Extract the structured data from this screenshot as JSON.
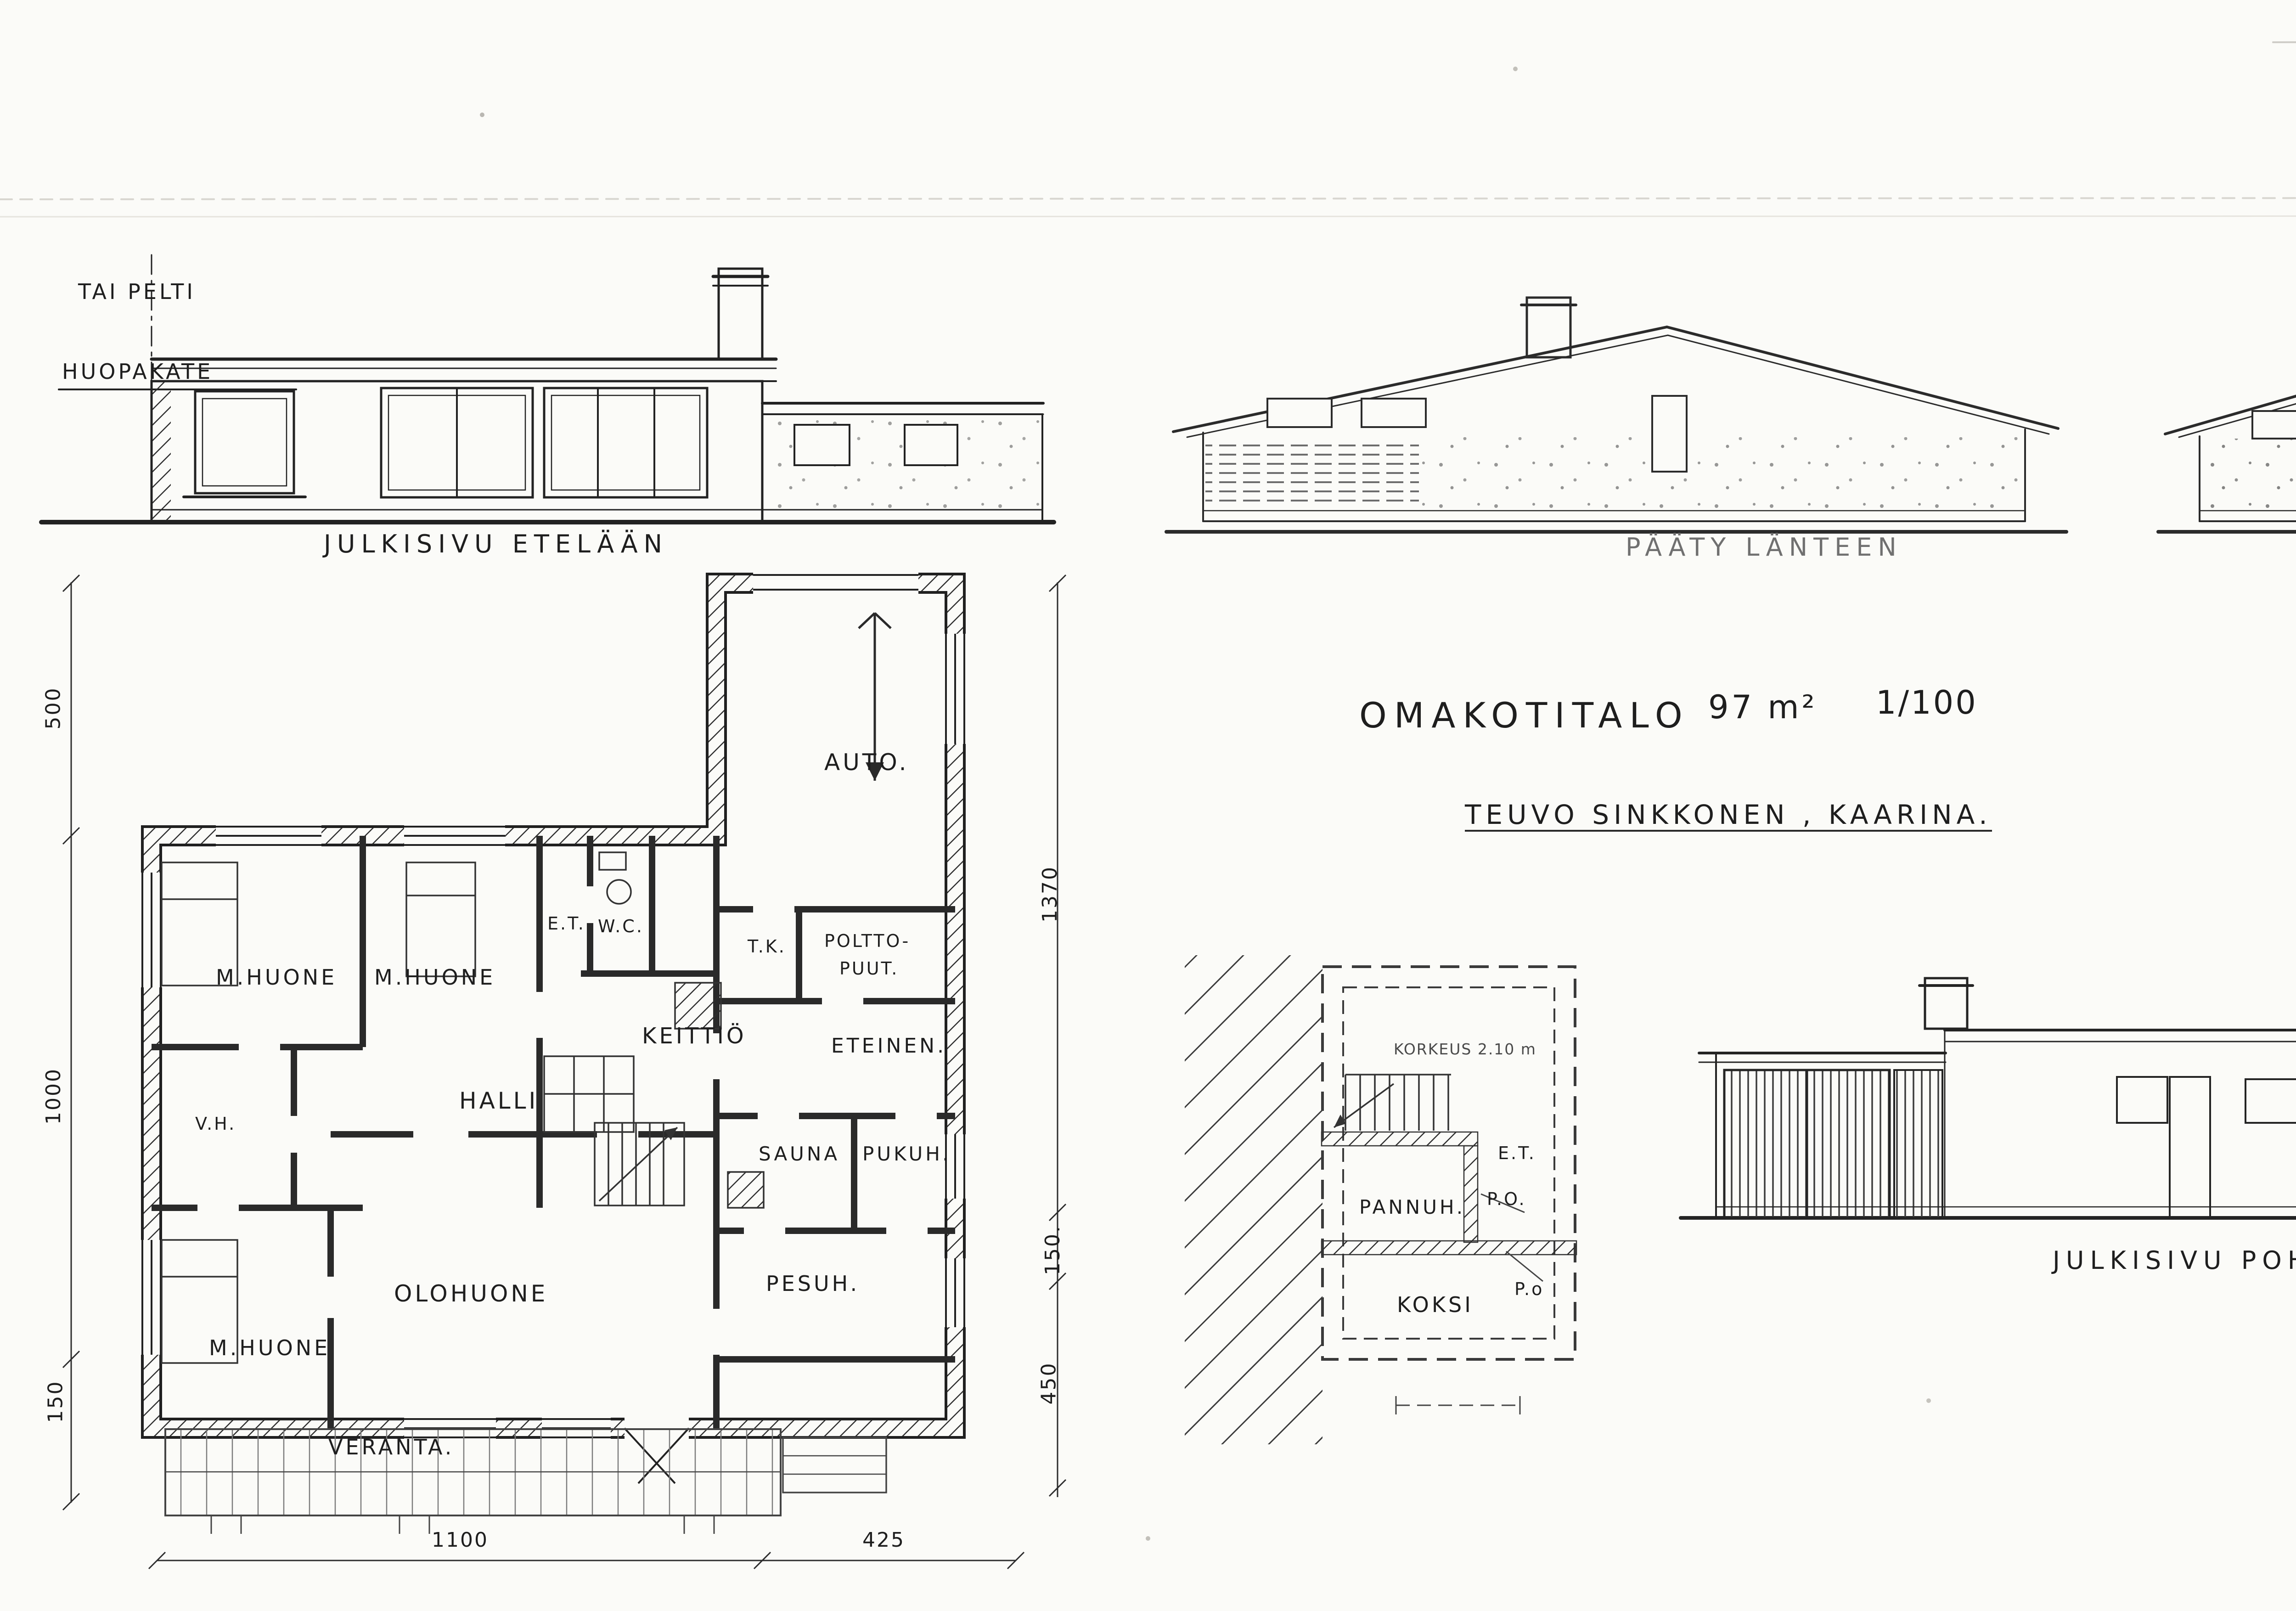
{
  "title_block": {
    "project": "OMAKOTITALO",
    "area": "97 m²",
    "scale": "1/100",
    "client": "TEUVO SINKKONEN , KAARINA."
  },
  "elevation_south": {
    "title": "JULKISIVU ETELÄÄN",
    "note_roof_alt": "TAI PELTI",
    "note_roof": "HUOPAKATE"
  },
  "elevation_west": {
    "title": "PÄÄTY LÄNTEEN"
  },
  "elevation_east": {
    "title": "PÄÄTY ITÄÄN.",
    "note_wall": "TIILI + RAPPAUS"
  },
  "elevation_north": {
    "title": "JULKISIVU POHJOISEEN"
  },
  "section": {
    "title": "LEIKKAUS A-A",
    "level_ridge": "+ 3.30",
    "level_eave": "+ 2.60",
    "level_floor": "± 0.00",
    "inner_height": "2.50",
    "note_cladding_1": "MINERIT",
    "note_cladding_2": "( ISO LEVY )"
  },
  "floor_plan": {
    "rooms": {
      "bedroom1": "M.HUONE",
      "bedroom2": "M.HUONE",
      "bedroom3": "M.HUONE",
      "living": "OLOHUONE",
      "hall": "HALLI",
      "kitchen": "KEITTIÖ",
      "entry": "E.T.",
      "wc": "W.C.",
      "closet": "V.H.",
      "garage": "AUTO.",
      "cold": "T.K.",
      "fuel1": "POLTTO-",
      "fuel2": "PUUT.",
      "vestibule": "ETEINEN.",
      "sauna": "SAUNA",
      "dressing": "PUKUH.",
      "wash": "PESUH.",
      "veranda": "VERANTA."
    },
    "dims": {
      "bottom_main": "1100",
      "bottom_side": "425",
      "left_top": "500",
      "left_mid": "1000",
      "left_low": "150",
      "right_top": "1370",
      "right_mid": "150.",
      "right_low": "450"
    }
  },
  "basement": {
    "height_note": "KORKEUS 2.10 m",
    "boiler": "PANNUH.",
    "coke": "KOKSI",
    "entry": "E.T.",
    "po_upper": "P.O.",
    "po_lower": "P.o"
  },
  "duct_plan": {
    "width_dim": "213",
    "labels": [
      "TALOUSKELLARI ILMA",
      "PANNUHUONE ILMA",
      "POLTTOAINES ILMA",
      "SAUNA + PESUH ILMA.",
      "KESKUSLÄMMITYS SAVU",
      "TAKAN SAVU",
      "KIUKAAN SAVU",
      "PADAN SAVU"
    ]
  },
  "approval": {
    "line1": "Kaarinan rakennuslautakunnan hyväk-",
    "line2_printed": "symä",
    "date_day": "6",
    "date_month": "/ 5",
    "year_printed": "19",
    "year_hand": "63"
  },
  "footer": {
    "place_date": "Piikkiö  25. 1. 1963.",
    "designer": "Rkm.  A.B.M.  Kautila"
  }
}
